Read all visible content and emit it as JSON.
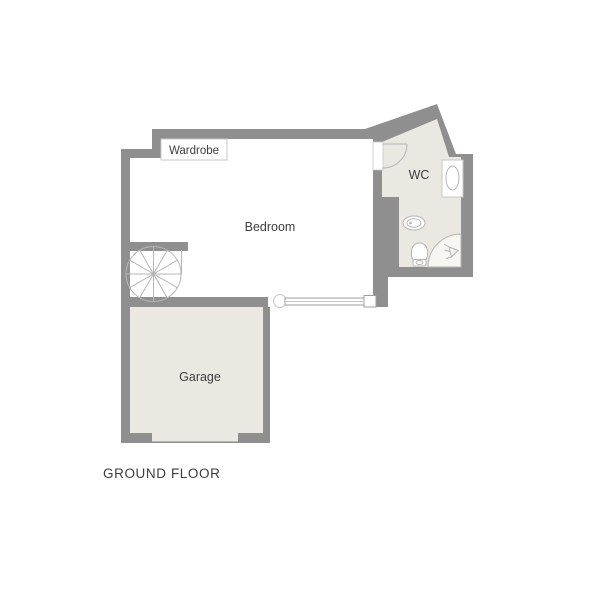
{
  "title": "GROUND FLOOR",
  "rooms": {
    "bedroom": {
      "label": "Bedroom"
    },
    "wc": {
      "label": "WC"
    },
    "garage": {
      "label": "Garage"
    },
    "wardrobe": {
      "label": "Wardrobe"
    }
  },
  "fixtures": [
    "spiral-staircase",
    "wc-door-swing",
    "washbasin",
    "basin-oval",
    "toilet",
    "shower-enclosure",
    "sliding-door",
    "garage-door"
  ],
  "colors": {
    "wall": "#8f8f8f",
    "floor": "#ebe8e2",
    "bedroom_floor": "#ffffff",
    "shower": "#f7f6f3",
    "stroke": "#b5b5b5",
    "border": "#c7c7c7",
    "door": "#9e9e9e",
    "text": "#3d3d3d",
    "bg": "#ffffff"
  }
}
